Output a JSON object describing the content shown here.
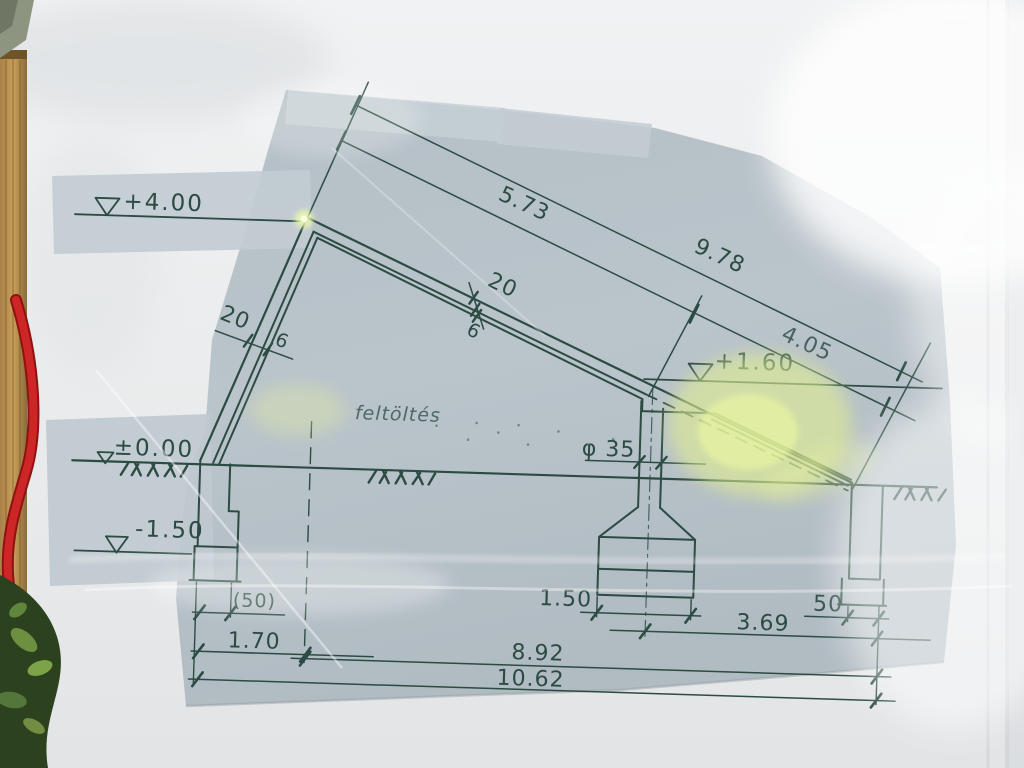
{
  "drawing": {
    "levels": {
      "roof_peak": "+4.00",
      "ground": "±0.00",
      "foundation": "-1.50",
      "eaves": "+1.60"
    },
    "slope_dimensions": {
      "upper_segment": "5.73",
      "lower_segment": "4.05",
      "total": "9.78"
    },
    "roof_thickness": {
      "outer": "20",
      "inner": "6"
    },
    "wall_thickness": {
      "outer": "20",
      "inner": "6"
    },
    "column_diameter": "φ 35",
    "note_backfill": "feltöltés",
    "bottom_dimensions": {
      "left_footing_width": "(50)",
      "left_bay": "1.70",
      "pedestal_width": "1.50",
      "right_bay": "3.69",
      "right_footing_width": "50",
      "span": "8.92",
      "overall": "10.62"
    }
  },
  "colors": {
    "ink": "#2c4b43",
    "sheet": "#b9c3c9",
    "poster": "#eceef0",
    "glare_yellow": "#e3f199",
    "cord_red": "#c42020",
    "wood_tan": "#c09a55",
    "foliage_dark": "#2c421f"
  }
}
